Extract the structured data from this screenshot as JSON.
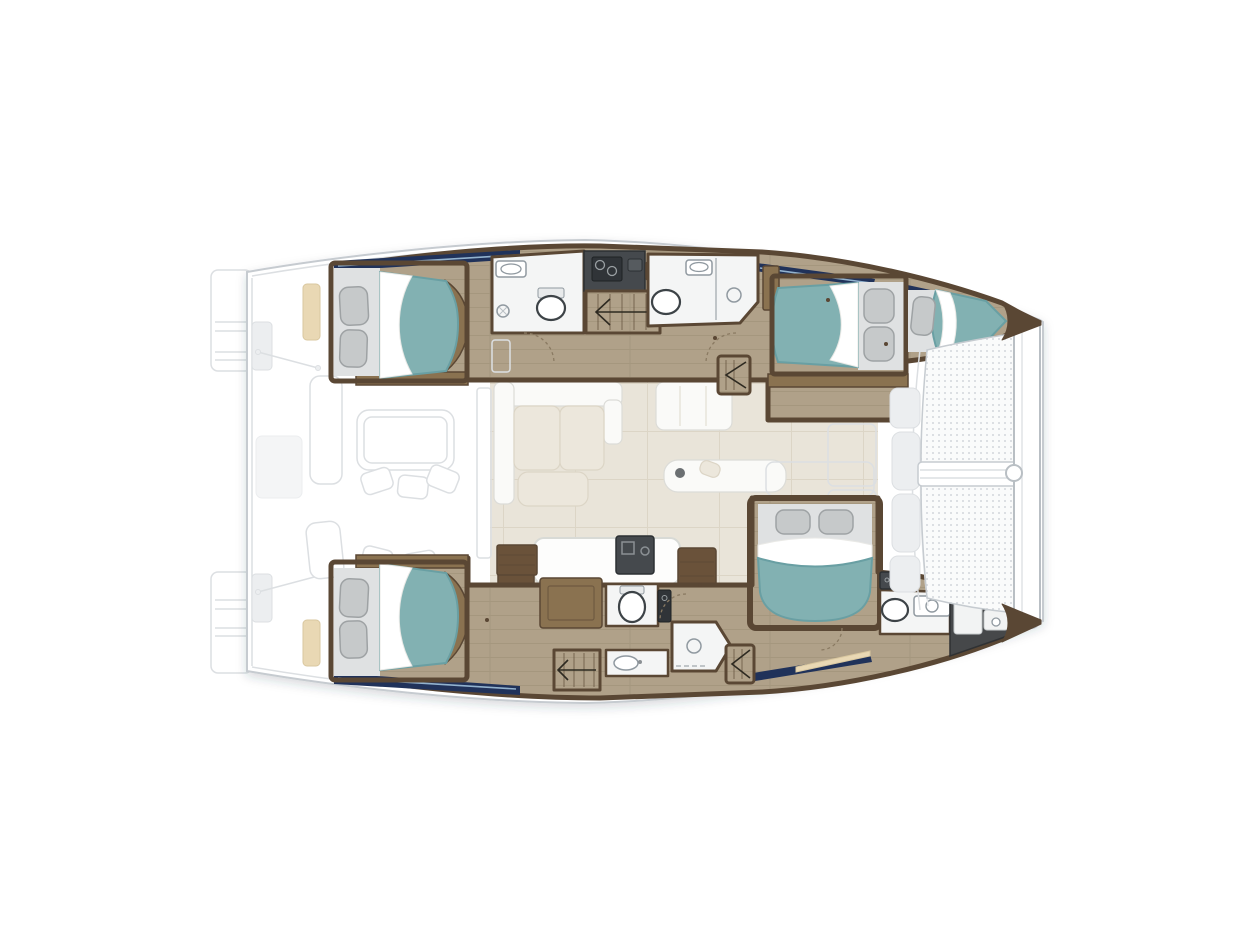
{
  "meta": {
    "aria_label": "Top-down interior layout plan of a sailing catamaran",
    "plan_type": "catamaran-interior-floor-plan"
  },
  "palette": {
    "hull_outline": "#c6cbd0",
    "deck_ghost": "#f6f7f8",
    "deck_panel": "#eceef0",
    "deck_line": "#dcdfe2",
    "wood_floor": "#b0a189",
    "plank_line": "#94866d",
    "wall_wood": "#5a4734",
    "furniture_wood": "#8a7250",
    "dark_wood": "#6a523a",
    "bed_teal": "#82b1b2",
    "bed_teal_deep": "#699fa3",
    "pillow_gray": "#c6c9ca",
    "pillow_shadow": "#9ea2a4",
    "platform_gray": "#dfe1e2",
    "linen": "#ffffff",
    "salon_floor": "#e9e4d9",
    "salon_line": "#d8d1c2",
    "bath_floor": "#f4f5f5",
    "fixture_stroke": "#9099a0",
    "counter_dark": "#45494d",
    "appliance_dark": "#303438",
    "window_navy": "#20325a",
    "window_blue": "#9fc0da",
    "accent_tan": "#e9d8b4",
    "mesh_bg": "#fafbfb",
    "mesh_dot": "#d3d7db"
  },
  "vessel": {
    "hulls": 2,
    "sleeping_areas": [
      {
        "id": "aft-port-cabin",
        "bed": "double",
        "bed_color": "teal"
      },
      {
        "id": "forward-port-cabin",
        "bed": "double",
        "bed_color": "teal"
      },
      {
        "id": "bow-port-berth",
        "bed": "single",
        "bed_color": "teal"
      },
      {
        "id": "aft-starboard-cabin",
        "bed": "double",
        "bed_color": "teal"
      },
      {
        "id": "forward-starboard-cabin",
        "bed": "double",
        "bed_color": "teal"
      }
    ],
    "bathrooms": [
      {
        "id": "port-aft-head",
        "fixtures": [
          "sink",
          "shower",
          "toilet"
        ]
      },
      {
        "id": "port-forward-head",
        "fixtures": [
          "toilet",
          "sink",
          "shower"
        ]
      },
      {
        "id": "starboard-mid-head",
        "fixtures": [
          "toilet",
          "sink",
          "shower"
        ]
      },
      {
        "id": "starboard-forward-head",
        "fixtures": [
          "toilet",
          "vanity-sink"
        ]
      }
    ],
    "common_areas": [
      "swim-platforms",
      "aft-cockpit",
      "saloon",
      "galley-island",
      "foredeck",
      "trampoline"
    ]
  }
}
